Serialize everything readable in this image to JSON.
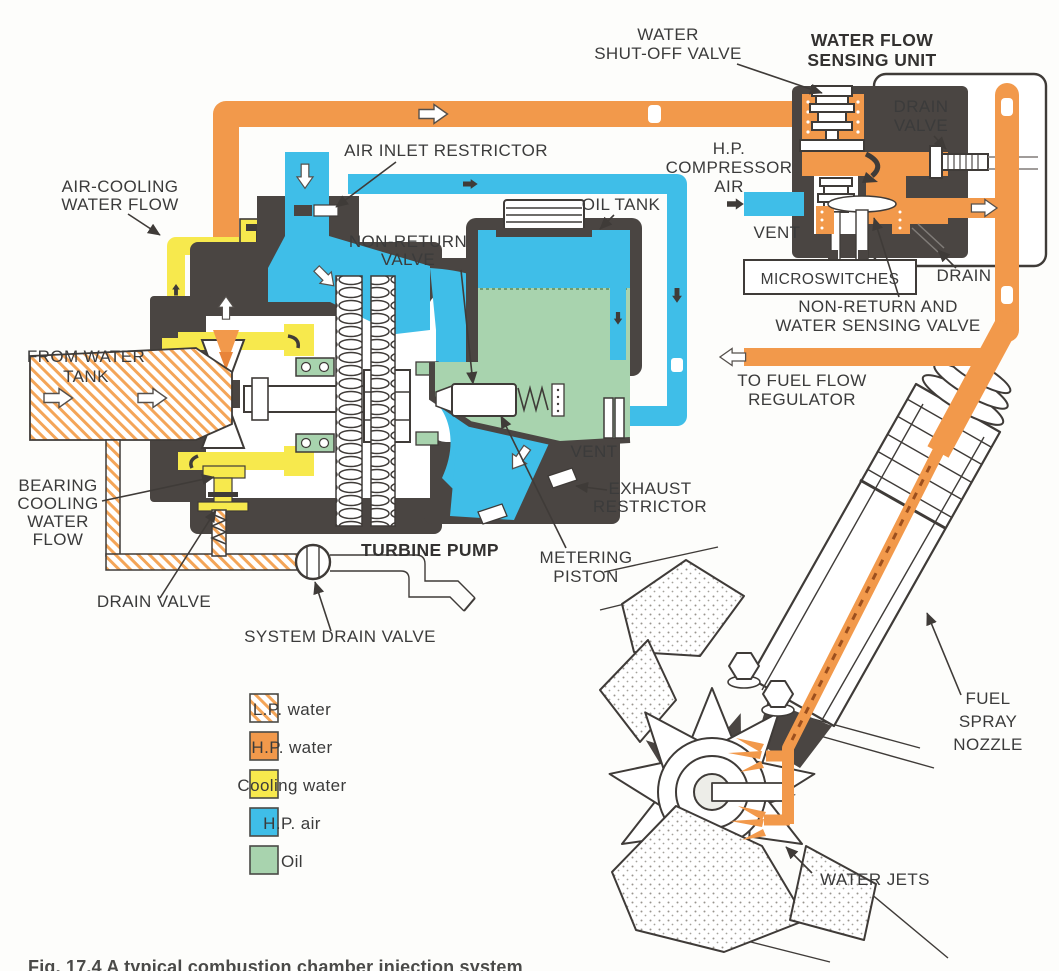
{
  "figure": {
    "caption": "Fig. 17.4 A typical combustion chamber injection system"
  },
  "labels": {
    "water_shut_off_valve": [
      "WATER",
      "SHUT-OFF VALVE"
    ],
    "water_flow_sensing_unit": [
      "WATER FLOW",
      "SENSING UNIT"
    ],
    "drain_valve_top": [
      "DRAIN",
      "VALVE"
    ],
    "hp_compressor_air": [
      "H.P.",
      "COMPRESSOR",
      "AIR"
    ],
    "vent_top": "VENT",
    "microswitches": "MICROSWITCHES",
    "drain": "DRAIN",
    "non_return_and_water_sensing_valve": [
      "NON-RETURN AND",
      "WATER SENSING VALVE"
    ],
    "to_fuel_flow_regulator": [
      "TO FUEL FLOW",
      "REGULATOR"
    ],
    "air_cooling_water_flow": [
      "AIR-COOLING",
      "WATER FLOW"
    ],
    "air_inlet_restrictor": "AIR INLET RESTRICTOR",
    "oil_tank": "OIL TANK",
    "non_return_valve": [
      "NON-RETURN",
      "VALVE"
    ],
    "from_water_tank": [
      "FROM WATER",
      "TANK"
    ],
    "bearing_cooling_water_flow": [
      "BEARING",
      "COOLING",
      "WATER",
      "FLOW"
    ],
    "vent_lower": "VENT",
    "exhaust_restrictor": [
      "EXHAUST",
      "RESTRICTOR"
    ],
    "turbine_pump": "TURBINE PUMP",
    "metering_piston": [
      "METERING",
      "PISTON"
    ],
    "drain_valve_lower": "DRAIN VALVE",
    "system_drain_valve": "SYSTEM DRAIN VALVE",
    "fuel_spray_nozzle": [
      "FUEL",
      "SPRAY",
      "NOZZLE"
    ],
    "water_jets": "WATER JETS"
  },
  "legend": {
    "items": [
      {
        "label": "L.P. water",
        "swatch": "diagonal-hatch",
        "color": "#F2994B"
      },
      {
        "label": "H.P. water",
        "swatch": "solid",
        "color": "#F2994B"
      },
      {
        "label": "Cooling water",
        "swatch": "solid",
        "color": "#F7E94D"
      },
      {
        "label": "H.P. air",
        "swatch": "solid",
        "color": "#3FBEE8"
      },
      {
        "label": "Oil",
        "swatch": "solid",
        "color": "#A8D3AE"
      }
    ]
  },
  "colors": {
    "hp_water": "#F2994B",
    "cooling_water": "#F7E94D",
    "hp_air": "#3FBEE8",
    "oil": "#A8D3AE",
    "casing": "#4A4542",
    "label_text": "#3B3B3B",
    "background": "#FDFDFB"
  }
}
